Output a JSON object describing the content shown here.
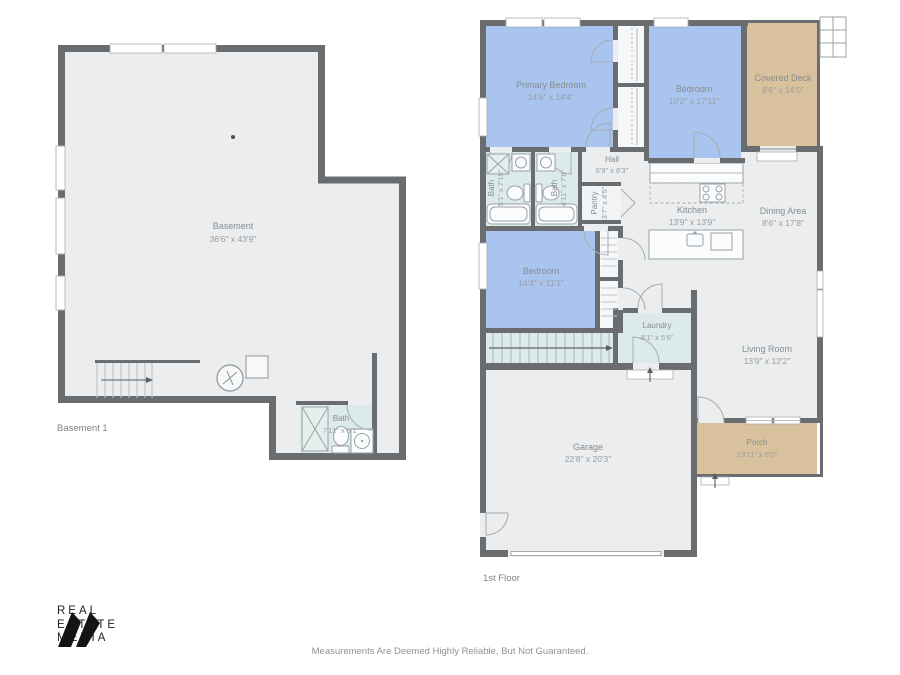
{
  "colors": {
    "wall": "#696d70",
    "floor": "#ebedee",
    "bedroom_fill": "#a9c4ee",
    "bath_fill": "#dcebe9",
    "deck_fill": "#d9c19d",
    "closet_fill": "#f6f7f8",
    "label_text": "#878d92",
    "dim_text": "#989ea3",
    "background": "#ffffff",
    "logo_color": "#1f1f1f"
  },
  "basement": {
    "floor_label": "Basement 1",
    "rooms": {
      "basement": {
        "name": "Basement",
        "dims": "36'6\" x 43'9\""
      },
      "bath": {
        "name": "Bath",
        "dims": "7'11\" x 5'1\""
      }
    }
  },
  "first_floor": {
    "floor_label": "1st Floor",
    "rooms": {
      "primary_bedroom": {
        "name": "Primary Bedroom",
        "dims": "14'6\" x 14'4\""
      },
      "bedroom_2": {
        "name": "Bedroom",
        "dims": "10'2\" x 17'11\""
      },
      "covered_deck": {
        "name": "Covered Deck",
        "dims": "8'6\" x 14'0\""
      },
      "hall": {
        "name": "Hall",
        "dims": "6'9\" x 6'3\""
      },
      "bath_1": {
        "name": "Bath",
        "dims": "5'1\" x 7'10\""
      },
      "bath_2": {
        "name": "Bath",
        "dims": "4'11\" x 7'8\""
      },
      "pantry": {
        "name": "Pantry",
        "dims": "3'7\" x 4'5\""
      },
      "kitchen": {
        "name": "Kitchen",
        "dims": "13'9\" x 13'9\""
      },
      "dining_area": {
        "name": "Dining Area",
        "dims": "8'6\" x 17'8\""
      },
      "bedroom_3": {
        "name": "Bedroom",
        "dims": "14'4\" x 11'1\""
      },
      "laundry": {
        "name": "Laundry",
        "dims": "8'1\" x 5'6\""
      },
      "living_room": {
        "name": "Living Room",
        "dims": "13'9\" x 12'2\""
      },
      "porch": {
        "name": "Porch",
        "dims": "13'11\" x 6'0\""
      },
      "garage": {
        "name": "Garage",
        "dims": "22'8\" x 20'3\""
      }
    }
  },
  "branding": {
    "name_lines": [
      "REAL",
      "ESTATE",
      "MEDIA"
    ]
  },
  "footer": {
    "disclaimer": "Measurements Are Deemed Highly Reliable, But Not Guaranteed."
  }
}
